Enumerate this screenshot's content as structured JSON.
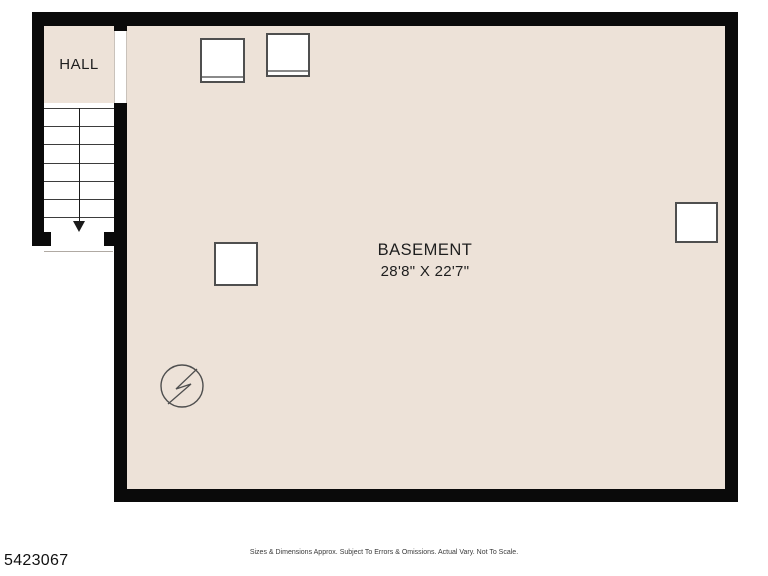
{
  "colors": {
    "background": "#FFFFFF",
    "floor": "#EDE2D8",
    "wall": "#0A0A0A",
    "line": "#4F4F4F"
  },
  "rooms": {
    "hall": {
      "label": "HALL"
    },
    "basement": {
      "label": "BASEMENT",
      "dimensions": "28'8\" X 22'7\""
    }
  },
  "symbols": {
    "stairs": {
      "icon": "down-arrow-icon",
      "direction": "down",
      "treads": 7
    },
    "electrical": {
      "icon": "circle-bolt-icon"
    },
    "appliances": [
      "appliance-square",
      "appliance-square"
    ],
    "posts": [
      "plain-square",
      "plain-square"
    ]
  },
  "footer": {
    "disclaimer": "Sizes & Dimensions Approx. Subject To Errors & Omissions. Actual Vary. Not To Scale.",
    "listing_id": "5423067"
  }
}
